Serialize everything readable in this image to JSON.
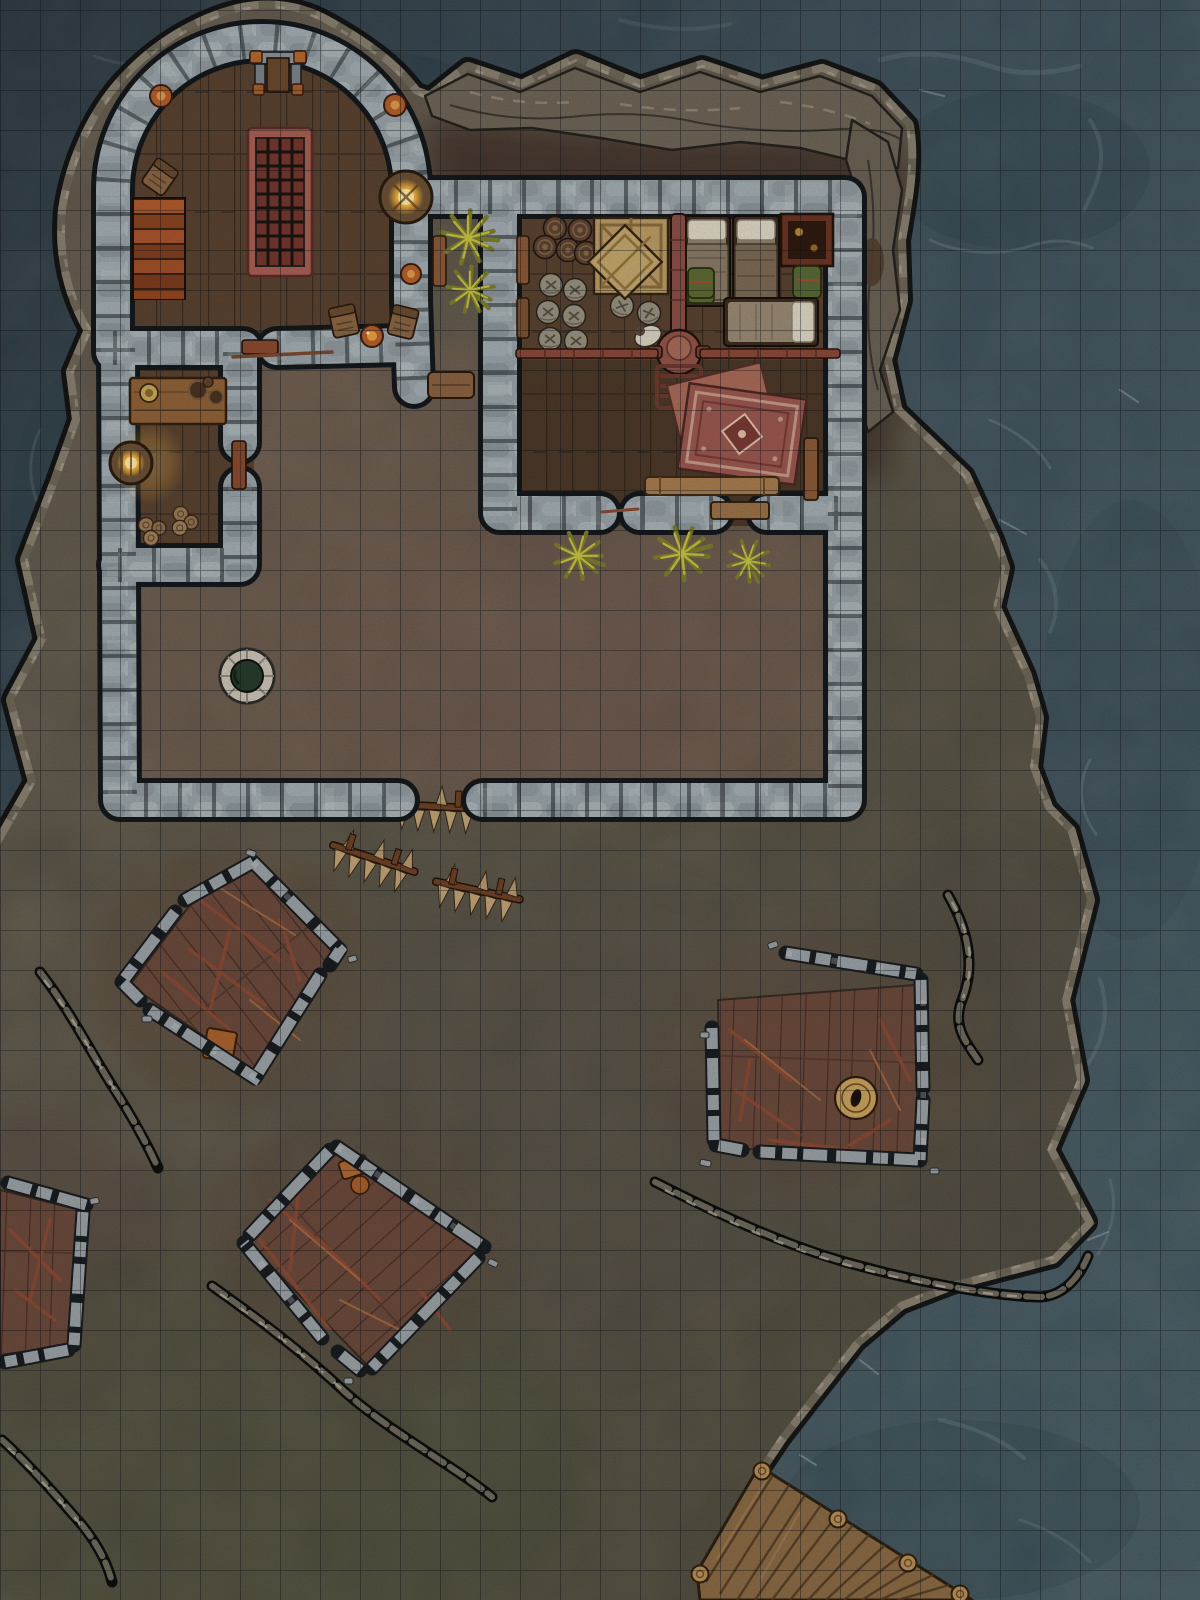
{
  "map": {
    "title_visible_text": null,
    "type": "top-down fantasy battle map (virtual tabletop)",
    "setting": "rocky island outpost surrounded by sea, stone compound with ruins and a dock",
    "grid": {
      "cell_px": 40,
      "columns": 30,
      "rows": 40,
      "offset_y_px": 10
    },
    "palette": {
      "water_deep": "#2c3a45",
      "water_mid": "#3d505b",
      "water_teal": "#44575f",
      "water_light": "#8fa5a7",
      "land_base": "#6e6557",
      "land_olive": "#5f5a48",
      "courtyard_dirt": "#81695a",
      "north_dirt": "#4d3c30",
      "cliff_rock": "#6e6557",
      "stone_light": "#aab3b7",
      "stone_mid": "#99a3a8",
      "stone_dark": "#7f898e",
      "wall_outline": "#15191c",
      "wood_floor": "#5a4331",
      "plank_line": "#3c2c1f",
      "ruin_floor": "#6b4a3c",
      "wood_warm": "#9a7248",
      "rug_red": "#9a5850",
      "rug_trim": "#c79a88",
      "glow_amber": "#e8a93a",
      "glow_bright": "#ffeaa2",
      "plant_olive": "#8f8f35",
      "plant_bright": "#c6c244",
      "barrel_dark": "#5f4433",
      "sack_gray": "#98917f",
      "crate_tan": "#bb9c64",
      "dock_wood": "#8a6a44",
      "well_water": "#273c2c",
      "debris": "#8a4a34",
      "grid_line": "rgba(12,16,18,0.5)"
    },
    "features": [
      {
        "name": "sea",
        "description": "dark teal ocean with light current streaks, fills all map edges"
      },
      {
        "name": "island",
        "description": "irregular rocky island with cliff rim, occupies center and lower-left"
      },
      {
        "name": "tower-hall",
        "grid_area": "C1-K9",
        "description": "round stone tower, wood floor, central iron grate table, stairs, lectern, chairs, wall fireplace, sconces"
      },
      {
        "name": "kitchen",
        "grid_area": "C9-F15",
        "description": "small room with counter, mugs and plates, wall oven glowing, firewood piles"
      },
      {
        "name": "bunkhouse",
        "grid_area": "M5-U13",
        "description": "large room: barrels, sacks, crates, three beds, cabinet, distilling furnace with chimney pipe, jug, ladder chair, ornate red rugs, bench"
      },
      {
        "name": "courtyard",
        "grid_area": "C9-U20",
        "description": "walled dirt yard with stone well"
      },
      {
        "name": "well",
        "grid_cell": "F17",
        "description": "round stone well with dark green water"
      },
      {
        "name": "gate-barricades",
        "grid_area": "I20-M23",
        "description": "three wooden spike barricades at wall gap"
      },
      {
        "name": "ruin-northwest",
        "grid_area": "C21-I27",
        "description": "diamond-oriented ruined hut, broken walls, red plank floor, debris"
      },
      {
        "name": "ruin-east",
        "grid_area": "R24-X29",
        "description": "rectangular ruin with large open barrel and beam debris"
      },
      {
        "name": "ruin-west-edge",
        "grid_area": "A29-C34",
        "description": "ruined hut cut by map edge"
      },
      {
        "name": "ruin-south-center",
        "grid_area": "F29-M34",
        "description": "diamond-oriented ruin with orange broken crate"
      },
      {
        "name": "rock-ridges",
        "description": "five dark jagged rock ridges scattered on southern half"
      },
      {
        "name": "bushes",
        "description": "yellow-green shrubs beside bunkhouse and below its south wall"
      },
      {
        "name": "dock",
        "grid_area": "R37-Y40",
        "description": "plank pier with mooring posts running into the sea at bottom right"
      }
    ]
  }
}
